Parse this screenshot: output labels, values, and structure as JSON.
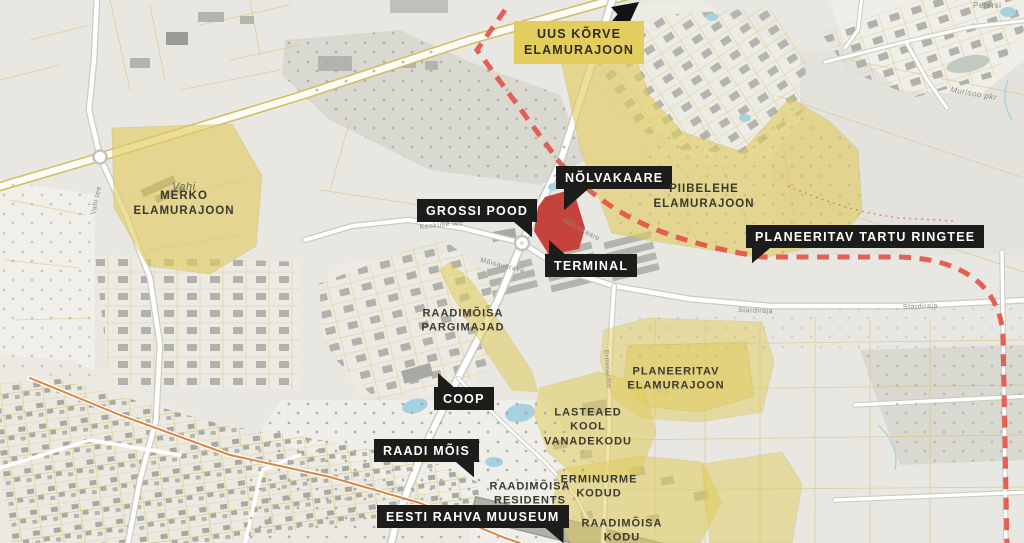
{
  "colors": {
    "highlight_yellow": "#e2cd5e",
    "development_red": "#c5433b",
    "ringroad_dash_red": "#e3544a",
    "label_box_black": "#1c1c1a",
    "label_text_white": "#ffffff",
    "map_label_dark": "#3a392f",
    "water_blue": "#a5d2e0",
    "orange_road": "#dd8342"
  },
  "callout_labels": [
    {
      "id": "uus-korve",
      "lines": [
        "UUS KÕRVE",
        "ELAMURAJOON"
      ],
      "style": "yellow-box"
    },
    {
      "id": "nolvakaare",
      "text": "NÕLVAKAARE",
      "style": "black-box"
    },
    {
      "id": "grossi-pood",
      "text": "GROSSI POOD",
      "style": "black-box"
    },
    {
      "id": "terminal",
      "text": "TERMINAL",
      "style": "black-box"
    },
    {
      "id": "tartu-ringtee",
      "text": "PLANEERITAV TARTU RINGTEE",
      "style": "black-box"
    },
    {
      "id": "coop",
      "text": "COOP",
      "style": "black-box"
    },
    {
      "id": "raadi-mois",
      "text": "RAADI MÕIS",
      "style": "black-box"
    },
    {
      "id": "eesti-rahva-muuseum",
      "text": "EESTI RAHVA MUUSEUM",
      "style": "black-box"
    }
  ],
  "area_labels": [
    {
      "id": "merko",
      "lines": [
        "MERKO",
        "ELAMURAJOON"
      ]
    },
    {
      "id": "piibelehe",
      "lines": [
        "PIIBELEHE",
        "ELAMURAJOON"
      ]
    },
    {
      "id": "raadimoisa-pargimajad",
      "lines": [
        "RAADIMÕISA",
        "PARGIMAJAD"
      ]
    },
    {
      "id": "planeeritav-elamurajoon",
      "lines": [
        "PLANEERITAV",
        "ELAMURAJOON"
      ]
    },
    {
      "id": "lasteaed-kool-vanadekodu",
      "lines": [
        "LASTEAED",
        "KOOL",
        "VANADEKODU"
      ]
    },
    {
      "id": "erminurme-kodud",
      "lines": [
        "ERMINURME",
        "KODUD"
      ]
    },
    {
      "id": "raadimoisa-residents",
      "lines": [
        "RAADIMÕISA",
        "RESIDENTS"
      ]
    },
    {
      "id": "raadimoisa-kodu",
      "lines": [
        "RAADIMÕISA",
        "KODU"
      ]
    }
  ],
  "street_labels": [
    "Vahi tee",
    "Keskuse tee",
    "Nõlvakaare",
    "Mõisavärava",
    "Stardiraja",
    "Stardiraja",
    "Erminurme",
    "Petersi",
    "Murisoo pkr"
  ],
  "place_labels": [
    "Vahi"
  ]
}
